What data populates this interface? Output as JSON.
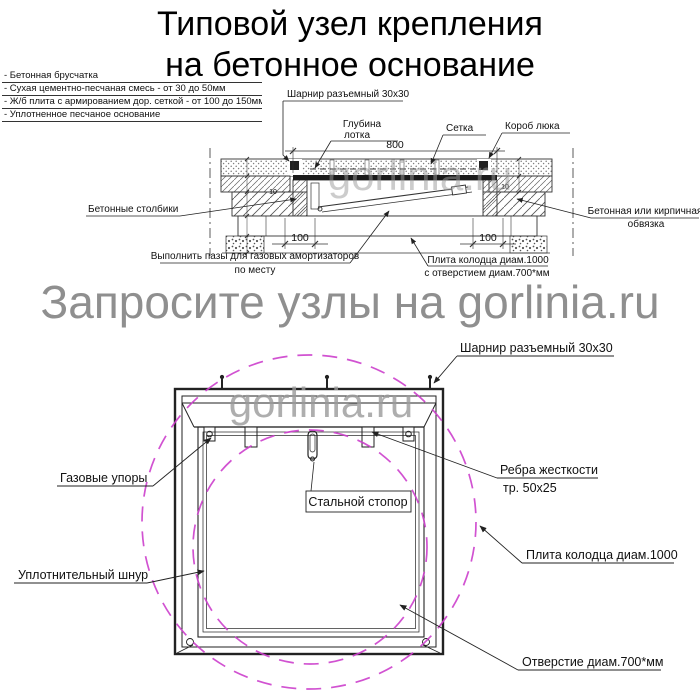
{
  "title": {
    "line1": "Типовой узел крепления",
    "line2": "на бетонное основание"
  },
  "legend": [
    "- Бетонная брусчатка",
    "- Сухая цементно-песчаная смесь - от 30 до 50мм",
    "- Ж/б плита с армированием дор. сеткой - от 100 до 150мм",
    "- Уплотненное песчаное основание"
  ],
  "watermarks": {
    "banner": "Запросите узлы на gorlinia.ru",
    "logo": "gorlinia.ru"
  },
  "section": {
    "labels": {
      "hinge": "Шарнир разъемный 30x30",
      "tray_depth_1": "Глубина",
      "tray_depth_2": "лотка",
      "mesh": "Сетка",
      "hatch_box": "Короб люка",
      "posts": "Бетонные столбики",
      "strapping_1": "Бетонная или кирпичная",
      "strapping_2": "обвязка",
      "grooves_1": "Выполнить пазы для газовых амортизаторов",
      "grooves_2": "по месту",
      "slab_1": "Плита колодца диам.1000",
      "slab_2": "с отверстием диам.700*мм"
    },
    "dims": {
      "lid_width": "800",
      "post_left": "100",
      "post_right": "100",
      "gap_left": "10",
      "gap_right": "10"
    }
  },
  "plan": {
    "labels": {
      "hinge": "Шарнир разъемный 30x30",
      "gas_struts": "Газовые упоры",
      "stopper": "Стальной стопор",
      "ribs_1": "Ребра жесткости",
      "ribs_2": "тр. 50x25",
      "slab": "Плита колодца диам.1000",
      "seal_cord": "Уплотнительный шнур",
      "hole": "Отверстие диам.700*мм"
    }
  },
  "colors": {
    "line": "#333333",
    "magenta": "#cc3fcc",
    "watermark": "#8f8f8f"
  }
}
